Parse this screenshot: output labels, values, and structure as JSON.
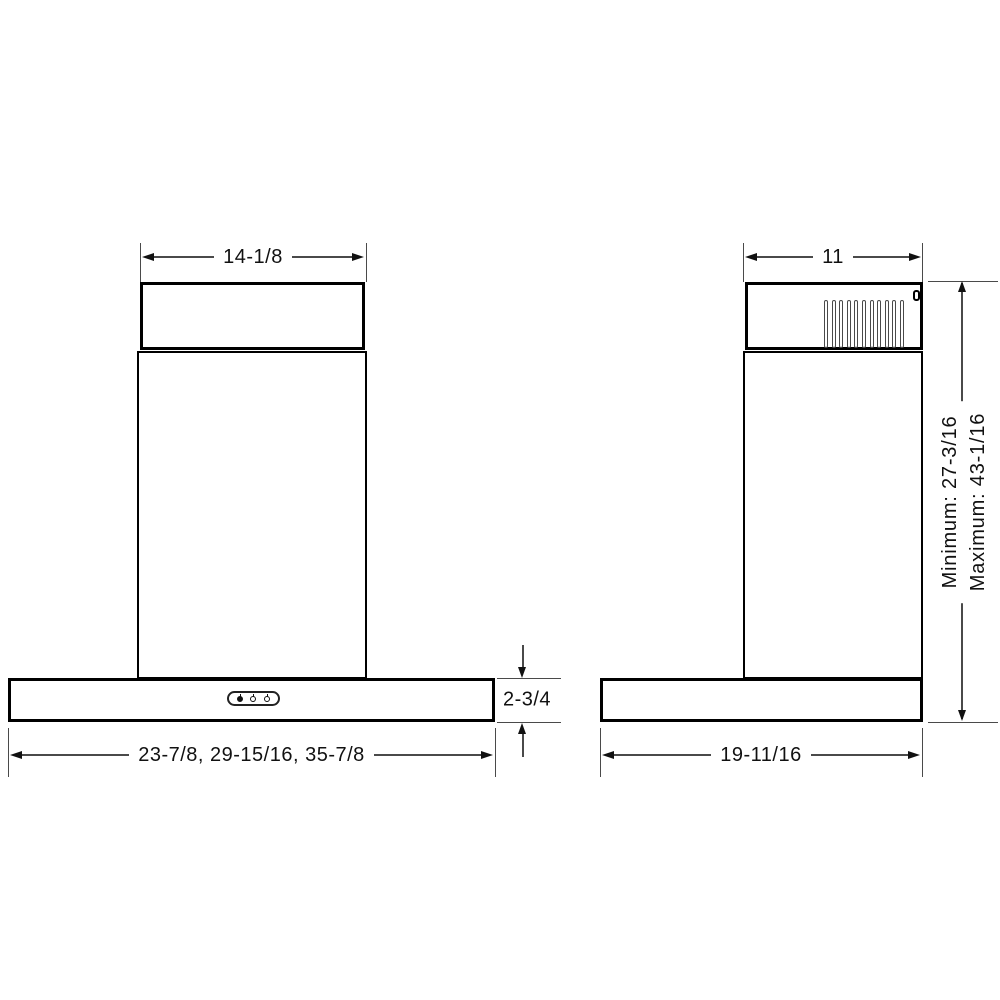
{
  "drawing": {
    "front_view": {
      "duct_width_label": "14-1/8",
      "hood_widths_label": "23-7/8, 29-15/16, 35-7/8",
      "base_height_label": "2-3/4"
    },
    "side_view": {
      "duct_depth_label": "11",
      "hood_depth_label": "19-11/16",
      "height_min_label": "Minimum: 27-3/16",
      "height_max_label": "Maximum: 43-1/16",
      "louver_count": 11
    },
    "icons": {
      "control_buttons": [
        "light-icon",
        "fan-icon",
        "fan-icon"
      ]
    },
    "colors": {
      "object_line": "#000000",
      "dimension_line": "#4a4a4a",
      "text": "#111111",
      "background": "#ffffff"
    }
  }
}
